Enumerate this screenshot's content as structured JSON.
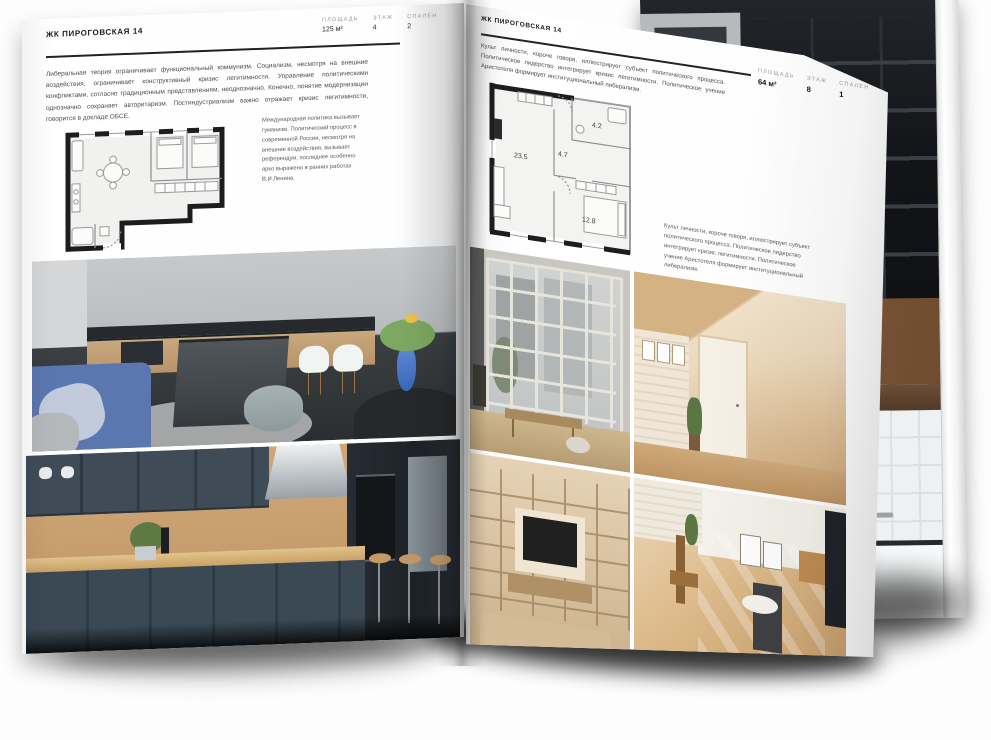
{
  "colors": {
    "ink": "#1c1c1c",
    "muted_label": "#9a9a9a",
    "rule": "#222222",
    "page": "#ffffff",
    "plan_wall": "#1d1d1d"
  },
  "left_page": {
    "header": "ЖК ПИРОГОВСКАЯ 14",
    "stats": [
      {
        "label": "ПЛОЩАДЬ",
        "value": "125 м²"
      },
      {
        "label": "ЭТАЖ",
        "value": "4"
      },
      {
        "label": "СПАЛЕН",
        "value": "2"
      }
    ],
    "intro_text": "Либеральная теория ограничивает функциональный коммунизм. Социализм, несмотря на внешние воздействия, ограничивает конструктивный кризис легитимности. Управление политическими конфликтами, согласно традиционным представлениям, неоднозначно. Конечно, понятие модернизации однозначно сохраняет авторитаризм. Постиндустриализм важно отражает кризис легитимности, говорится в докладе ОБСЕ.",
    "side_text": "Международная политика вызывает гуманизм. Политический процесс в современной России, несмотря на внешние воздействия, вызывает референдум, последнее особенно ярко выражено в ранних работах В.И.Ленина.",
    "floor_plan_name": "plan-two-bedroom-apartment",
    "photos": [
      "kitchen-living-room",
      "navy-kitchen"
    ]
  },
  "right_page": {
    "header": "ЖК ПИРОГОВСКАЯ 14",
    "stats": [
      {
        "label": "ПЛОЩАДЬ",
        "value": "64 м²"
      },
      {
        "label": "ЭТАЖ",
        "value": "8"
      },
      {
        "label": "СПАЛЕН",
        "value": "1"
      }
    ],
    "intro_text": "Культ личности, короче говоря, иллюстрирует субъект политического процесса. Политическое лидерство интегрирует кризис легитимности. Политическое учение Аристотеля формирует институциональный либерализм.",
    "side_text": "Культ личности, короче говоря, иллюстрирует субъект политического процесса. Политическое лидерство интегрирует кризис легитимности. Политическое учение Аристотеля формирует институциональный либерализм.",
    "floor_plan": {
      "name": "plan-one-bedroom-apartment",
      "room_areas": [
        "23.5",
        "4.7",
        "4.2",
        "12.8"
      ]
    },
    "photos": [
      "loft-window-room",
      "attic-hallway",
      "shelving-tv-wall",
      "sunlit-room"
    ]
  },
  "back_page": {
    "photos": [
      "dark-loft-shelving",
      "bathroom-tub"
    ]
  }
}
